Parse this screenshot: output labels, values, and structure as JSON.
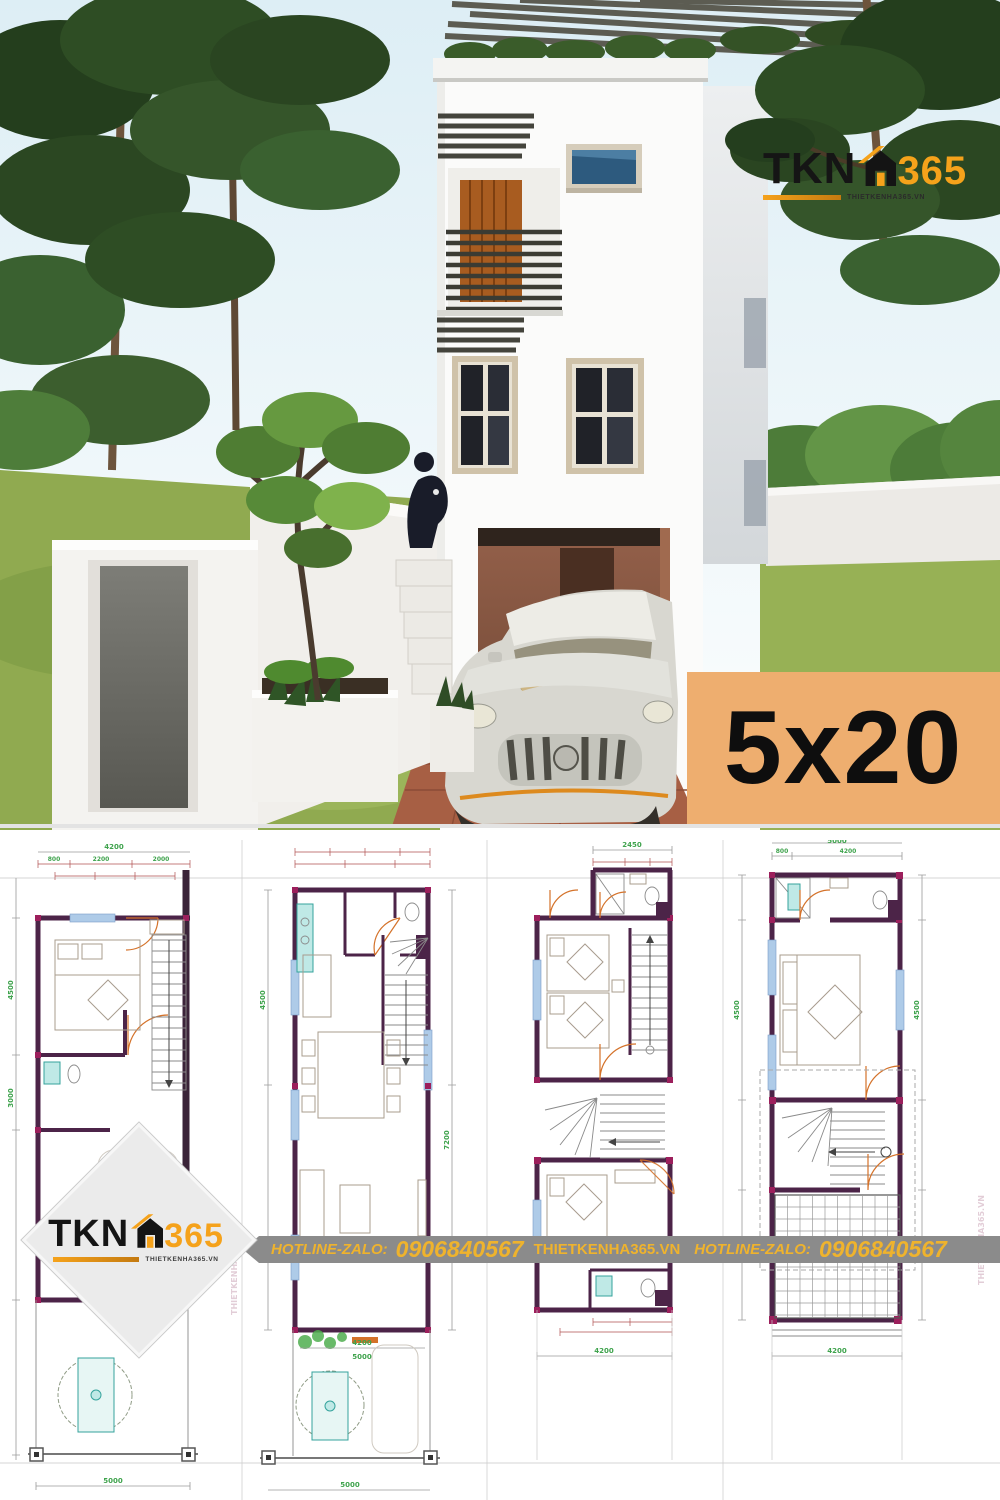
{
  "brand": {
    "tkn": "TKN",
    "n365": "365",
    "site": "THIETKENHA365.VN",
    "orange": "#F5A21B",
    "black": "#151515"
  },
  "badge": {
    "label": "5x20",
    "bg": "#EEAE6F",
    "text_color": "#0e0e0e"
  },
  "banner": {
    "label1": "HOTLINE-ZALO:",
    "phone1": "0906840567",
    "site": "THIETKENHA365.VN",
    "label2": "HOTLINE-ZALO:",
    "phone2": "0906840567",
    "bg": "#8B8B8B",
    "fg": "#EFB32D"
  },
  "plans": {
    "watermark": "THIETKENHA365.VN",
    "colors": {
      "wall": "#4C2448",
      "dimension": "#b05050",
      "label": "#3FA34D",
      "window": "#AECBE8",
      "fixture": "#35a39c",
      "door": "#D4722A"
    },
    "dims": {
      "c1_top": "4200",
      "c1_top_subs": [
        "800",
        "2200",
        "2000"
      ],
      "c1_left_a": "4500",
      "c1_left_b": "3000",
      "c1_bottom": "5000",
      "c2_left": "4500",
      "c2_right": "7200",
      "c2_mid_a": "4200",
      "c2_mid_b": "5000",
      "c2_bottom": "5000",
      "c3_top": "2450",
      "c3_bottom": "4200",
      "c4_top": "5000",
      "c4_top_subs": [
        "800",
        "4200"
      ],
      "c4_left": "4500",
      "c4_right": "4500",
      "c4_bottom": "4200"
    }
  }
}
